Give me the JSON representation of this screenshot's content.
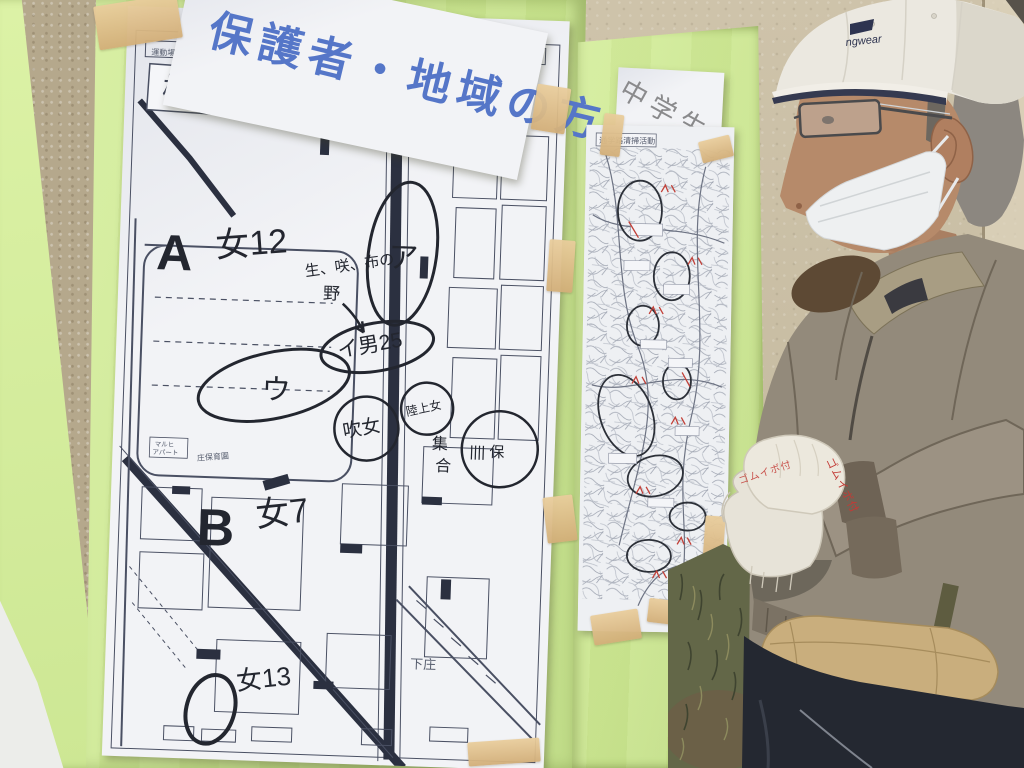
{
  "banner": {
    "text": "保護者・地域の方"
  },
  "left_map": {
    "title": "校舎周辺清掃活動",
    "printed_labels": {
      "ground": "運動場",
      "nursery": "庄保育園",
      "apartment_line1": "マルヒ",
      "apartment_line2": "アパート",
      "district": "下庄"
    },
    "annotations": {
      "a_letter": "A",
      "a_count": "女12",
      "area_a": "ア",
      "note_line1": "生、咲、布の",
      "note_line2": "野",
      "group_i": "イ男25",
      "area_u": "ウ",
      "club_band": "吹女",
      "club_track": "陸上女",
      "tally": "|||| 保",
      "gather_top": "集",
      "gather_bottom": "合",
      "b_letter": "B",
      "b_count": "女7",
      "c_count": "女13"
    }
  },
  "right_board": {
    "label": "中学生",
    "map_title": "通学路清掃活動"
  },
  "man": {
    "cap_brand": "ngwear",
    "glove_brand": "ゴムイボ付"
  },
  "colors": {
    "board_green": "#cde897",
    "tape": "#ddb887",
    "banner_ink": "#5576c8",
    "marker_ink": "#23262f",
    "red_ink": "#c24038"
  }
}
